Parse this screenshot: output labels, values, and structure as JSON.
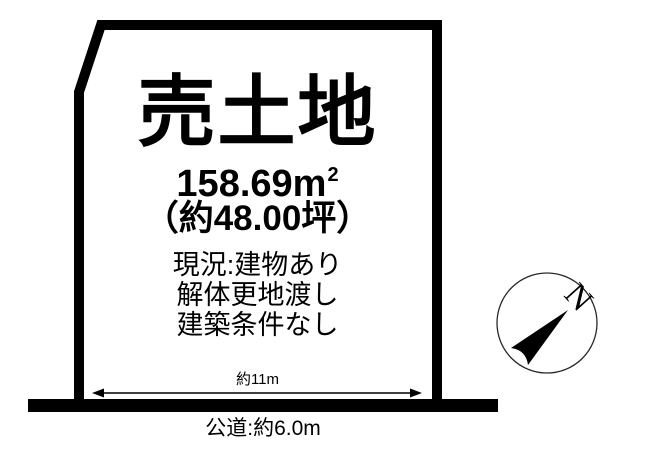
{
  "listing": {
    "title": "売土地",
    "area_value": "158.69m",
    "area_unit_sup": "2",
    "area_tsubo": "（約48.00坪）",
    "notes": [
      "現況:建物あり",
      "解体更地渡し",
      "建築条件なし"
    ],
    "frontage_label": "約11m",
    "road_label": "公道:約6.0m"
  },
  "compass": {
    "north_label": "N"
  },
  "colors": {
    "ink": "#000000",
    "background": "#ffffff",
    "compass_stroke": "#2a2a2a"
  }
}
